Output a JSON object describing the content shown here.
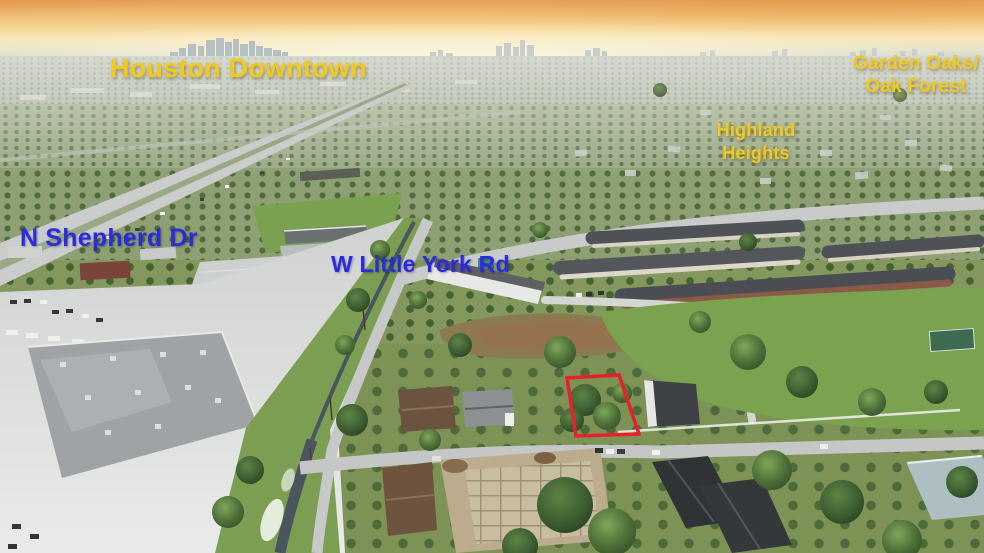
{
  "labels": {
    "downtown": "Houston Downtown",
    "garden_oaks_1": "Garden Oaks/",
    "garden_oaks_2": "Oak Forest",
    "highland_1": "Highland",
    "highland_2": "Heights",
    "n_shepherd": "N Shepherd Dr",
    "w_little_york": "W Little York Rd"
  },
  "colors": {
    "neighborhood_label": "#F1CA1E",
    "street_label": "#2A2BDE",
    "parcel_outline": "#E8202E"
  }
}
